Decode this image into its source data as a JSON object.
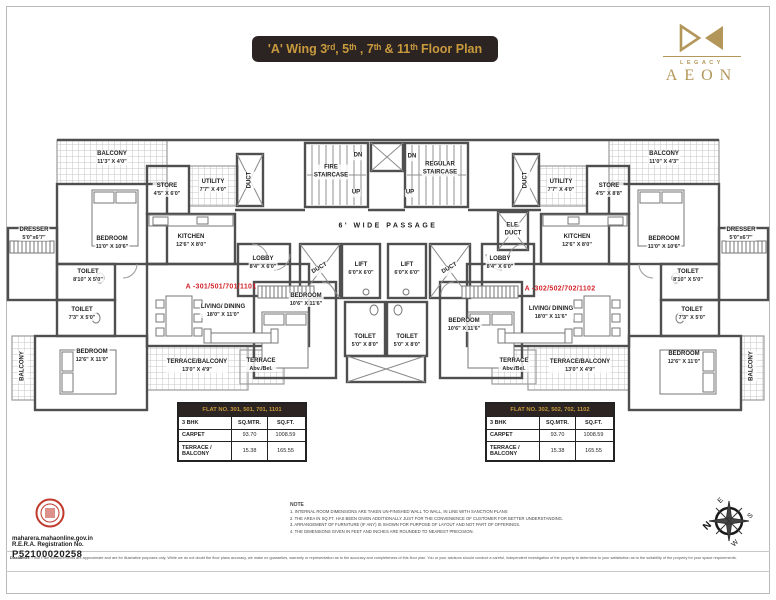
{
  "header": {
    "title": "'A' Wing 3ʳᵈ, 5ᵗʰ , 7ᵗʰ & 11ᵗʰ Floor Plan"
  },
  "brand": {
    "legacy": "LEGACY",
    "name": "AEON",
    "gold": "#b39659"
  },
  "colors": {
    "accent_gold": "#c89a3d",
    "title_bg": "#2b2422",
    "unit_red": "#d2232a",
    "wall_gray": "#4f4f4f"
  },
  "units": {
    "left": "A -301/501/701/1101",
    "right": "A -302/502/702/1102"
  },
  "rooms": {
    "balcony_a": {
      "name": "BALCONY",
      "dims": "11'3\" X 4'0\""
    },
    "balcony_b": {
      "name": "BALCONY",
      "dims": "11'0\" X 4'3\""
    },
    "balcony_v": {
      "name": "BALCONY"
    },
    "store_l": {
      "name": "STORE",
      "dims": "4'5\" X 6'0\""
    },
    "store_r": {
      "name": "STORE",
      "dims": "4'5\" X 8'8\""
    },
    "utility": {
      "name": "UTILITY",
      "dims": "7'7\" X 4'0\""
    },
    "kitchen": {
      "name": "KITCHEN",
      "dims": "12'6\" X 8'0\""
    },
    "bedroom_top": {
      "name": "BEDROOM",
      "dims": "11'0\" X 10'6\""
    },
    "bedroom_bottom": {
      "name": "BEDROOM",
      "dims": "12'6\" X 11'0\""
    },
    "bedroom_center": {
      "name": "BEDROOM",
      "dims": "10'6\" X 11'6\""
    },
    "dresser": {
      "name": "DRESSER",
      "dims": "5'0\"x6'7\""
    },
    "toilet_big": {
      "name": "TOILET",
      "dims": "8'10\" X 5'0\""
    },
    "toilet_small": {
      "name": "TOILET",
      "dims": "7'3\" X 5'0\""
    },
    "toilet_center": {
      "name": "TOILET",
      "dims": "5'0\" X 8'0\""
    },
    "living_l": {
      "name": "LIVING/ DINING",
      "dims": "18'0\" X 11'0\""
    },
    "living_r": {
      "name": "LIVING/ DINING",
      "dims": "18'0\" X 11'6\""
    },
    "terrace_balcony": {
      "name": "TERRACE/BALCONY",
      "dims": "13'0\" X 4'9\""
    },
    "terrace_abv": {
      "name": "TERRACE",
      "dims": "Abv./Bel."
    },
    "lobby": {
      "name": "LOBBY",
      "dims": "8'4\" X 6'0\""
    },
    "lift": {
      "name": "LIFT",
      "dims": "6'0\"X 6'0\""
    },
    "duct": {
      "name": "DUCT"
    },
    "ele_duct": {
      "name": "ELE.",
      "dims": "DUCT"
    },
    "fire_stair": {
      "name": "FIRE",
      "dims": "STAIRCASE"
    },
    "regular_stair": {
      "name": "REGULAR",
      "dims": "STAIRCASE"
    },
    "dn": {
      "name": "DN"
    },
    "up": {
      "name": "UP"
    },
    "passage": {
      "name": "6' WIDE PASSAGE"
    }
  },
  "tables": {
    "left": {
      "title": "FLAT NO. 301, 501, 701, 1101",
      "rows": [
        [
          "3 BHK",
          "SQ.MTR.",
          "SQ.FT."
        ],
        [
          "CARPET",
          "93.70",
          "1008.59"
        ],
        [
          "TERRACE / BALCONY",
          "15.38",
          "165.55"
        ]
      ]
    },
    "right": {
      "title": "FLAT NO. 302, 502, 702, 1102",
      "rows": [
        [
          "3 BHK",
          "SQ.MTR.",
          "SQ.FT."
        ],
        [
          "CARPET",
          "93.70",
          "1008.59"
        ],
        [
          "TERRACE / BALCONY",
          "15.38",
          "165.55"
        ]
      ]
    }
  },
  "footer": {
    "rera": {
      "site": "maharera.mahaonline.gov.in",
      "label": "R.E.R.A. Registration No.",
      "number": "P52100020258"
    },
    "note": {
      "heading": "NOTE",
      "items": [
        "1.  INTERNAL ROOM DIMENSIONS ARE TAKEN UN-FINISHED WALL TO WALL, IN LINE WITH SANCTION PLANS",
        "2.  THE AREA IN SQ.FT. HAS BEEN GIVEN ADDITIONALLY JUST FOR THE CONVENIENCE OF CUSTOMER FOR BETTER UNDERSTANDING.",
        "3.  ARRANGEMENT OF FURNITURE (IF ANY) IS SHOWN FOR PURPOSE OF LAYOUT AND NOT PART OF OFFERINGS.",
        "4.  THE DIMENSIONS GIVEN IN FEET AND INCHES ARE ROUNDED TO NEAREST PRECISION."
      ]
    },
    "compass": {
      "n": "N",
      "e": "E",
      "s": "S",
      "w": "W"
    },
    "disclaimer_label": "Disclaimer:",
    "disclaimer_text": " Floor Plan measurements are approximate and are for illustrative purposes only. While we do not doubt the floor plans accuracy, we make no guaranties, warranty or representation as to the accuracy and completeness of this floor plan. You or your advisors should conduct a careful, independent investigation of the property to determine to your satisfaction as to the suitability of the property for your space requirements."
  }
}
